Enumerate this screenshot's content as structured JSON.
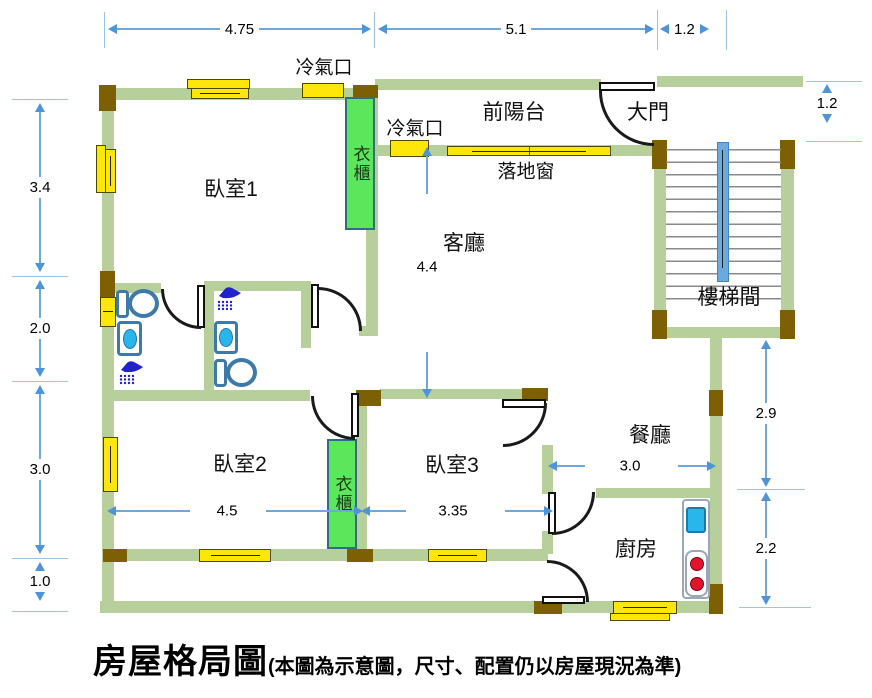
{
  "title": {
    "main": "房屋格局圖",
    "sub": "(本圖為示意圖，尺寸、配置仍以房屋現況為準)"
  },
  "rooms": {
    "bedroom1": "臥室1",
    "bedroom2": "臥室2",
    "bedroom3": "臥室3",
    "living_room": "客廳",
    "dining_room": "餐廳",
    "kitchen": "廚房",
    "front_balcony": "前陽台",
    "main_door": "大門",
    "stairwell": "樓梯間"
  },
  "features": {
    "wardrobe": "衣櫃",
    "ac_vent": "冷氣口",
    "floor_window": "落地窗"
  },
  "dims": {
    "top": [
      "4.75",
      "5.1",
      "1.2"
    ],
    "left": [
      "3.4",
      "2.0",
      "3.0",
      "1.0"
    ],
    "right": [
      "1.2",
      "2.9",
      "2.2"
    ],
    "living_depth": "4.4",
    "bedroom2_width": "4.5",
    "bedroom3_width": "3.35",
    "dining_width": "3.0"
  },
  "colors": {
    "wall_green": "#b6cf9b",
    "wood_brown": "#7d6004",
    "window_yellow": "#ffe60a",
    "wardrobe_green": "#5ce65c",
    "dimension_blue": "#6fa8dc",
    "stair_rail_blue": "#6fa8dc",
    "fixture_blue": "#3d7aa8",
    "water_blue": "#29b6ea",
    "stove_red": "#e3122d"
  }
}
